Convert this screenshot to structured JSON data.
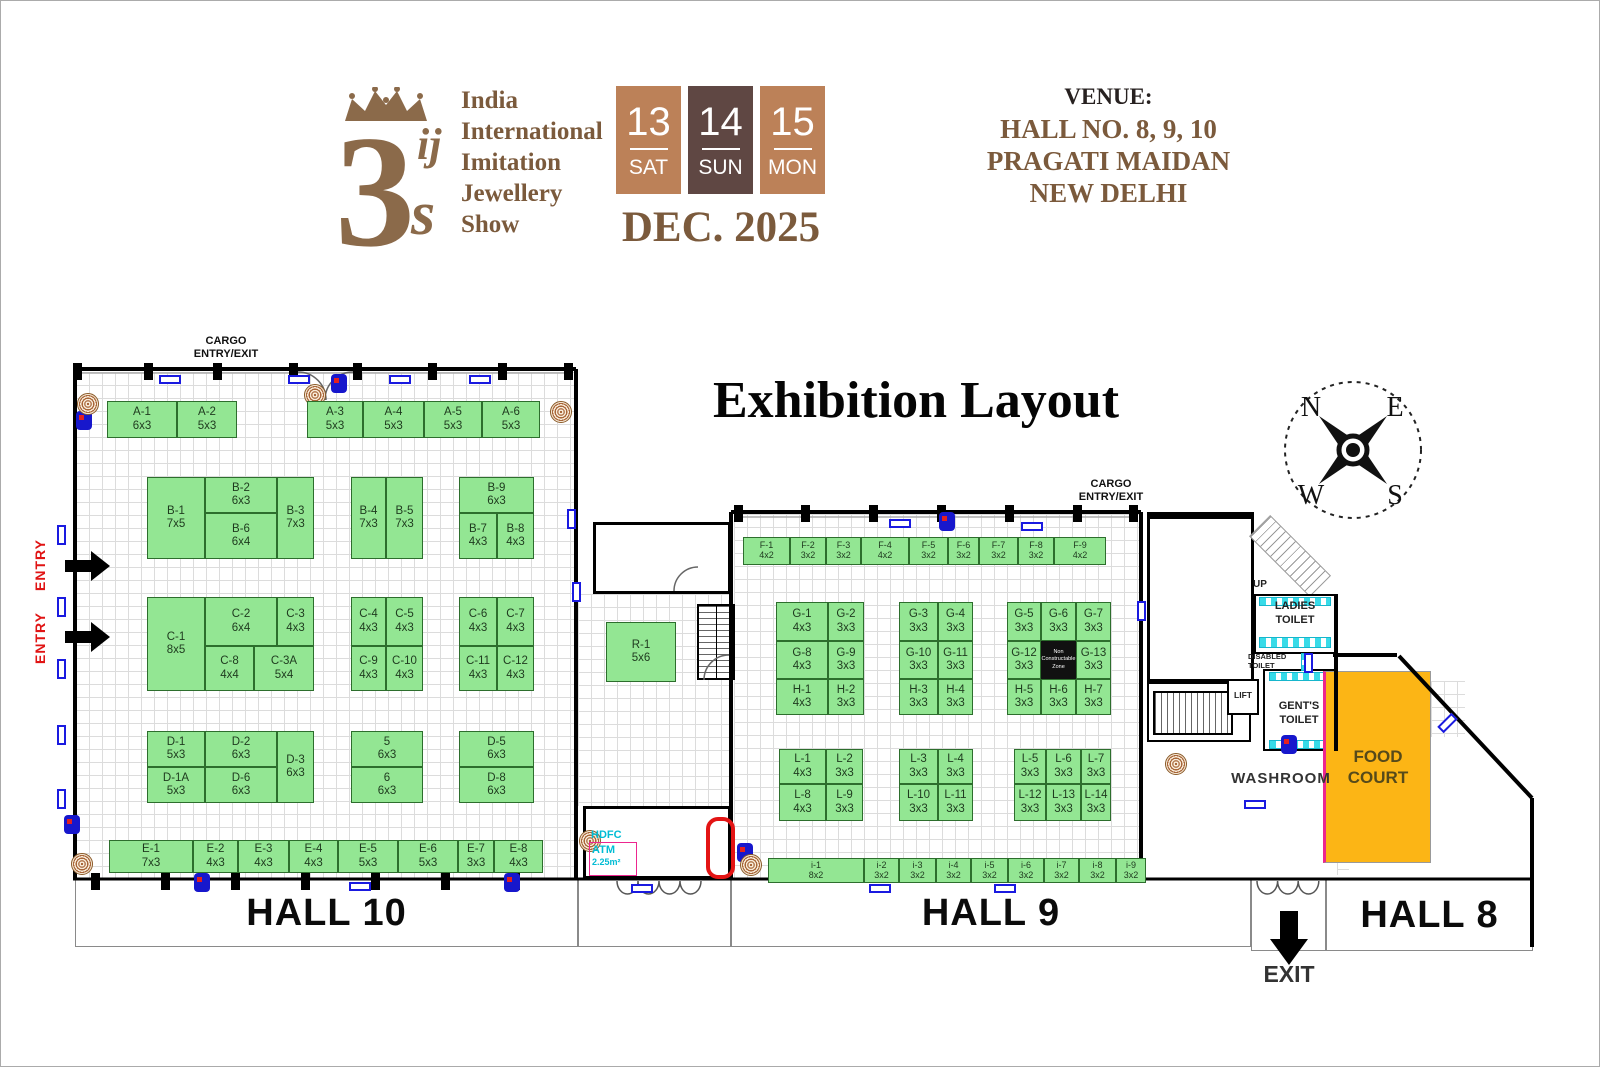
{
  "header": {
    "logo": {
      "number": "3",
      "l1": "ij",
      "l2": "s",
      "title": "India\nInternational\nImitation\nJewellery\nShow"
    },
    "dates": [
      {
        "day": "13",
        "dow": "SAT",
        "bg": "#bc8158"
      },
      {
        "day": "14",
        "dow": "SUN",
        "bg": "#5f4743"
      },
      {
        "day": "15",
        "dow": "MON",
        "bg": "#bc8158"
      }
    ],
    "month_year": "DEC. 2025",
    "venue": {
      "label": "VENUE:",
      "lines": "HALL NO. 8, 9, 10\nPRAGATI MAIDAN\nNEW DELHI"
    }
  },
  "plan_title": "Exhibition Layout",
  "compass": {
    "n": "N",
    "e": "E",
    "w": "W",
    "s": "S"
  },
  "labels": {
    "cargo": "CARGO\nENTRY/EXIT",
    "entry": "ENTRY",
    "exit": "EXIT",
    "hall10": "HALL 10",
    "hall9": "HALL 9",
    "hall8": "HALL 8",
    "washroom": "WASHROOM",
    "food_court": "FOOD\nCOURT",
    "ladies": "LADIES\nTOILET",
    "gents": "GENT'S\nTOILET",
    "disabled": "DISABLED\nTOILET",
    "lift": "LIFT",
    "up": "UP",
    "ncz": "Non\nConstructable\nZone",
    "atm_bank": "HDFC",
    "atm": "ATM",
    "atm_area": "2.25m²"
  },
  "booths": [
    {
      "id": "A-1",
      "size": "6x3",
      "x": 106,
      "y": 400,
      "w": 70,
      "h": 37
    },
    {
      "id": "A-2",
      "size": "5x3",
      "x": 176,
      "y": 400,
      "w": 60,
      "h": 37
    },
    {
      "id": "A-3",
      "size": "5x3",
      "x": 306,
      "y": 400,
      "w": 56,
      "h": 37
    },
    {
      "id": "A-4",
      "size": "5x3",
      "x": 362,
      "y": 400,
      "w": 61,
      "h": 37
    },
    {
      "id": "A-5",
      "size": "5x3",
      "x": 423,
      "y": 400,
      "w": 58,
      "h": 37
    },
    {
      "id": "A-6",
      "size": "5x3",
      "x": 481,
      "y": 400,
      "w": 58,
      "h": 37
    },
    {
      "id": "B-1",
      "size": "7x5",
      "x": 146,
      "y": 476,
      "w": 58,
      "h": 82
    },
    {
      "id": "B-2",
      "size": "6x3",
      "x": 204,
      "y": 476,
      "w": 72,
      "h": 36
    },
    {
      "id": "B-6",
      "size": "6x4",
      "x": 204,
      "y": 512,
      "w": 72,
      "h": 46
    },
    {
      "id": "B-3",
      "size": "7x3",
      "x": 276,
      "y": 476,
      "w": 37,
      "h": 82
    },
    {
      "id": "B-4",
      "size": "7x3",
      "x": 350,
      "y": 476,
      "w": 35,
      "h": 82
    },
    {
      "id": "B-5",
      "size": "7x3",
      "x": 385,
      "y": 476,
      "w": 37,
      "h": 82
    },
    {
      "id": "B-9",
      "size": "6x3",
      "x": 458,
      "y": 476,
      "w": 75,
      "h": 36
    },
    {
      "id": "B-7",
      "size": "4x3",
      "x": 458,
      "y": 512,
      "w": 38,
      "h": 46
    },
    {
      "id": "B-8",
      "size": "4x3",
      "x": 496,
      "y": 512,
      "w": 37,
      "h": 46
    },
    {
      "id": "C-1",
      "size": "8x5",
      "x": 146,
      "y": 596,
      "w": 58,
      "h": 94
    },
    {
      "id": "C-2",
      "size": "6x4",
      "x": 204,
      "y": 596,
      "w": 72,
      "h": 49
    },
    {
      "id": "C-3",
      "size": "4x3",
      "x": 276,
      "y": 596,
      "w": 37,
      "h": 49
    },
    {
      "id": "C-8",
      "size": "4x4",
      "x": 204,
      "y": 645,
      "w": 49,
      "h": 45
    },
    {
      "id": "C-3A",
      "size": "5x4",
      "x": 253,
      "y": 645,
      "w": 60,
      "h": 45
    },
    {
      "id": "C-4",
      "size": "4x3",
      "x": 350,
      "y": 596,
      "w": 35,
      "h": 49
    },
    {
      "id": "C-5",
      "size": "4x3",
      "x": 385,
      "y": 596,
      "w": 37,
      "h": 49
    },
    {
      "id": "C-9",
      "size": "4x3",
      "x": 350,
      "y": 645,
      "w": 35,
      "h": 45
    },
    {
      "id": "C-10",
      "size": "4x3",
      "x": 385,
      "y": 645,
      "w": 37,
      "h": 45
    },
    {
      "id": "C-6",
      "size": "4x3",
      "x": 458,
      "y": 596,
      "w": 38,
      "h": 49
    },
    {
      "id": "C-7",
      "size": "4x3",
      "x": 496,
      "y": 596,
      "w": 37,
      "h": 49
    },
    {
      "id": "C-11",
      "size": "4x3",
      "x": 458,
      "y": 645,
      "w": 38,
      "h": 45
    },
    {
      "id": "C-12",
      "size": "4x3",
      "x": 496,
      "y": 645,
      "w": 37,
      "h": 45
    },
    {
      "id": "D-1",
      "size": "5x3",
      "x": 146,
      "y": 730,
      "w": 58,
      "h": 36
    },
    {
      "id": "D-2",
      "size": "6x3",
      "x": 204,
      "y": 730,
      "w": 72,
      "h": 36
    },
    {
      "id": "D-3",
      "size": "6x3",
      "x": 276,
      "y": 730,
      "w": 37,
      "h": 72
    },
    {
      "id": "D-1A",
      "size": "5x3",
      "x": 146,
      "y": 766,
      "w": 58,
      "h": 36
    },
    {
      "id": "D-6",
      "size": "6x3",
      "x": 204,
      "y": 766,
      "w": 72,
      "h": 36
    },
    {
      "id": "5",
      "size": "6x3",
      "x": 350,
      "y": 730,
      "w": 72,
      "h": 36
    },
    {
      "id": "6",
      "size": "6x3",
      "x": 350,
      "y": 766,
      "w": 72,
      "h": 36
    },
    {
      "id": "D-5",
      "size": "6x3",
      "x": 458,
      "y": 730,
      "w": 75,
      "h": 36
    },
    {
      "id": "D-8",
      "size": "6x3",
      "x": 458,
      "y": 766,
      "w": 75,
      "h": 36
    },
    {
      "id": "E-1",
      "size": "7x3",
      "x": 108,
      "y": 839,
      "w": 84,
      "h": 33
    },
    {
      "id": "E-2",
      "size": "4x3",
      "x": 192,
      "y": 839,
      "w": 45,
      "h": 33
    },
    {
      "id": "E-3",
      "size": "4x3",
      "x": 237,
      "y": 839,
      "w": 51,
      "h": 33
    },
    {
      "id": "E-4",
      "size": "4x3",
      "x": 288,
      "y": 839,
      "w": 49,
      "h": 33
    },
    {
      "id": "E-5",
      "size": "5x3",
      "x": 337,
      "y": 839,
      "w": 60,
      "h": 33
    },
    {
      "id": "E-6",
      "size": "5x3",
      "x": 397,
      "y": 839,
      "w": 60,
      "h": 33
    },
    {
      "id": "E-7",
      "size": "3x3",
      "x": 457,
      "y": 839,
      "w": 36,
      "h": 33
    },
    {
      "id": "E-8",
      "size": "4x3",
      "x": 493,
      "y": 839,
      "w": 49,
      "h": 33
    },
    {
      "id": "R-1",
      "size": "5x6",
      "x": 605,
      "y": 621,
      "w": 70,
      "h": 60
    },
    {
      "id": "F-1",
      "size": "4x2",
      "x": 742,
      "y": 536,
      "w": 47,
      "h": 28
    },
    {
      "id": "F-2",
      "size": "3x2",
      "x": 789,
      "y": 536,
      "w": 36,
      "h": 28
    },
    {
      "id": "F-3",
      "size": "3x2",
      "x": 825,
      "y": 536,
      "w": 35,
      "h": 28
    },
    {
      "id": "F-4",
      "size": "4x2",
      "x": 860,
      "y": 536,
      "w": 48,
      "h": 28
    },
    {
      "id": "F-5",
      "size": "3x2",
      "x": 908,
      "y": 536,
      "w": 39,
      "h": 28
    },
    {
      "id": "F-6",
      "size": "3x2",
      "x": 947,
      "y": 536,
      "w": 31,
      "h": 28
    },
    {
      "id": "F-7",
      "size": "3x2",
      "x": 978,
      "y": 536,
      "w": 39,
      "h": 28
    },
    {
      "id": "F-8",
      "size": "3x2",
      "x": 1017,
      "y": 536,
      "w": 36,
      "h": 28
    },
    {
      "id": "F-9",
      "size": "4x2",
      "x": 1053,
      "y": 536,
      "w": 52,
      "h": 28
    },
    {
      "id": "G-1",
      "size": "4x3",
      "x": 775,
      "y": 601,
      "w": 52,
      "h": 39
    },
    {
      "id": "G-2",
      "size": "3x3",
      "x": 827,
      "y": 601,
      "w": 36,
      "h": 39
    },
    {
      "id": "G-3",
      "size": "3x3",
      "x": 898,
      "y": 601,
      "w": 39,
      "h": 39
    },
    {
      "id": "G-4",
      "size": "3x3",
      "x": 937,
      "y": 601,
      "w": 35,
      "h": 39
    },
    {
      "id": "G-5",
      "size": "3x3",
      "x": 1006,
      "y": 601,
      "w": 34,
      "h": 39
    },
    {
      "id": "G-6",
      "size": "3x3",
      "x": 1040,
      "y": 601,
      "w": 35,
      "h": 39
    },
    {
      "id": "G-7",
      "size": "3x3",
      "x": 1075,
      "y": 601,
      "w": 35,
      "h": 39
    },
    {
      "id": "G-8",
      "size": "4x3",
      "x": 775,
      "y": 640,
      "w": 52,
      "h": 38
    },
    {
      "id": "G-9",
      "size": "3x3",
      "x": 827,
      "y": 640,
      "w": 36,
      "h": 38
    },
    {
      "id": "G-10",
      "size": "3x3",
      "x": 898,
      "y": 640,
      "w": 39,
      "h": 38
    },
    {
      "id": "G-11",
      "size": "3x3",
      "x": 937,
      "y": 640,
      "w": 35,
      "h": 38
    },
    {
      "id": "G-12",
      "size": "3x3",
      "x": 1006,
      "y": 640,
      "w": 34,
      "h": 38
    },
    {
      "id": "G-13",
      "size": "3x3",
      "x": 1075,
      "y": 640,
      "w": 35,
      "h": 38
    },
    {
      "id": "H-1",
      "size": "4x3",
      "x": 775,
      "y": 678,
      "w": 52,
      "h": 36
    },
    {
      "id": "H-2",
      "size": "3x3",
      "x": 827,
      "y": 678,
      "w": 36,
      "h": 36
    },
    {
      "id": "H-3",
      "size": "3x3",
      "x": 898,
      "y": 678,
      "w": 39,
      "h": 36
    },
    {
      "id": "H-4",
      "size": "3x3",
      "x": 937,
      "y": 678,
      "w": 35,
      "h": 36
    },
    {
      "id": "H-5",
      "size": "3x3",
      "x": 1006,
      "y": 678,
      "w": 34,
      "h": 36
    },
    {
      "id": "H-6",
      "size": "3x3",
      "x": 1040,
      "y": 678,
      "w": 35,
      "h": 36
    },
    {
      "id": "H-7",
      "size": "3x3",
      "x": 1075,
      "y": 678,
      "w": 35,
      "h": 36
    },
    {
      "id": "L-1",
      "size": "4x3",
      "x": 778,
      "y": 748,
      "w": 47,
      "h": 35
    },
    {
      "id": "L-2",
      "size": "3x3",
      "x": 825,
      "y": 748,
      "w": 37,
      "h": 35
    },
    {
      "id": "L-3",
      "size": "3x3",
      "x": 898,
      "y": 748,
      "w": 39,
      "h": 35
    },
    {
      "id": "L-4",
      "size": "3x3",
      "x": 937,
      "y": 748,
      "w": 35,
      "h": 35
    },
    {
      "id": "L-5",
      "size": "3x3",
      "x": 1013,
      "y": 748,
      "w": 32,
      "h": 35
    },
    {
      "id": "L-6",
      "size": "3x3",
      "x": 1045,
      "y": 748,
      "w": 35,
      "h": 35
    },
    {
      "id": "L-7",
      "size": "3x3",
      "x": 1080,
      "y": 748,
      "w": 30,
      "h": 35
    },
    {
      "id": "L-8",
      "size": "4x3",
      "x": 778,
      "y": 783,
      "w": 47,
      "h": 37
    },
    {
      "id": "L-9",
      "size": "3x3",
      "x": 825,
      "y": 783,
      "w": 37,
      "h": 37
    },
    {
      "id": "L-10",
      "size": "3x3",
      "x": 898,
      "y": 783,
      "w": 39,
      "h": 37
    },
    {
      "id": "L-11",
      "size": "3x3",
      "x": 937,
      "y": 783,
      "w": 35,
      "h": 37
    },
    {
      "id": "L-12",
      "size": "3x3",
      "x": 1013,
      "y": 783,
      "w": 32,
      "h": 37
    },
    {
      "id": "L-13",
      "size": "3x3",
      "x": 1045,
      "y": 783,
      "w": 35,
      "h": 37
    },
    {
      "id": "L-14",
      "size": "3x3",
      "x": 1080,
      "y": 783,
      "w": 30,
      "h": 37
    },
    {
      "id": "i-1",
      "size": "8x2",
      "x": 767,
      "y": 857,
      "w": 96,
      "h": 25
    },
    {
      "id": "i-2",
      "size": "3x2",
      "x": 863,
      "y": 857,
      "w": 35,
      "h": 25
    },
    {
      "id": "i-3",
      "size": "3x2",
      "x": 898,
      "y": 857,
      "w": 37,
      "h": 25
    },
    {
      "id": "i-4",
      "size": "3x2",
      "x": 935,
      "y": 857,
      "w": 35,
      "h": 25
    },
    {
      "id": "i-5",
      "size": "3x2",
      "x": 970,
      "y": 857,
      "w": 37,
      "h": 25
    },
    {
      "id": "i-6",
      "size": "3x2",
      "x": 1007,
      "y": 857,
      "w": 36,
      "h": 25
    },
    {
      "id": "i-7",
      "size": "3x2",
      "x": 1043,
      "y": 857,
      "w": 35,
      "h": 25
    },
    {
      "id": "i-8",
      "size": "3x2",
      "x": 1078,
      "y": 857,
      "w": 37,
      "h": 25
    },
    {
      "id": "i-9",
      "size": "3x2",
      "x": 1115,
      "y": 857,
      "w": 30,
      "h": 25
    }
  ],
  "fixtures": {
    "columns": [
      [
        72,
        362
      ],
      [
        143,
        362
      ],
      [
        212,
        362
      ],
      [
        288,
        362
      ],
      [
        352,
        362
      ],
      [
        427,
        362
      ],
      [
        497,
        362
      ],
      [
        563,
        362
      ],
      [
        733,
        504
      ],
      [
        800,
        504
      ],
      [
        868,
        504
      ],
      [
        936,
        504
      ],
      [
        1004,
        504
      ],
      [
        1072,
        504
      ],
      [
        1128,
        504
      ],
      [
        90,
        872
      ],
      [
        160,
        872
      ],
      [
        230,
        872
      ],
      [
        300,
        872
      ],
      [
        370,
        872
      ],
      [
        440,
        872
      ],
      [
        510,
        872
      ]
    ],
    "hticks": [
      [
        158,
        374
      ],
      [
        287,
        374
      ],
      [
        388,
        374
      ],
      [
        468,
        374
      ],
      [
        888,
        518
      ],
      [
        1020,
        521
      ],
      [
        348,
        881
      ],
      [
        630,
        883
      ],
      [
        868,
        883
      ],
      [
        993,
        883
      ],
      [
        1243,
        799
      ]
    ],
    "vticks": [
      [
        56,
        524,
        0
      ],
      [
        56,
        596,
        0
      ],
      [
        56,
        658,
        0
      ],
      [
        56,
        724,
        0
      ],
      [
        56,
        788,
        0
      ],
      [
        566,
        508,
        0
      ],
      [
        571,
        581,
        0
      ],
      [
        1136,
        600,
        0
      ],
      [
        1303,
        652,
        0
      ],
      [
        1442,
        712,
        45
      ]
    ],
    "extinguishers": [
      [
        75,
        410
      ],
      [
        330,
        373
      ],
      [
        63,
        814
      ],
      [
        193,
        872
      ],
      [
        503,
        872
      ],
      [
        938,
        511
      ],
      [
        1280,
        734
      ],
      [
        736,
        842
      ]
    ],
    "spirals": [
      [
        76,
        392
      ],
      [
        303,
        383
      ],
      [
        549,
        400
      ],
      [
        70,
        852
      ],
      [
        578,
        829
      ],
      [
        739,
        853
      ],
      [
        1164,
        752
      ]
    ]
  }
}
